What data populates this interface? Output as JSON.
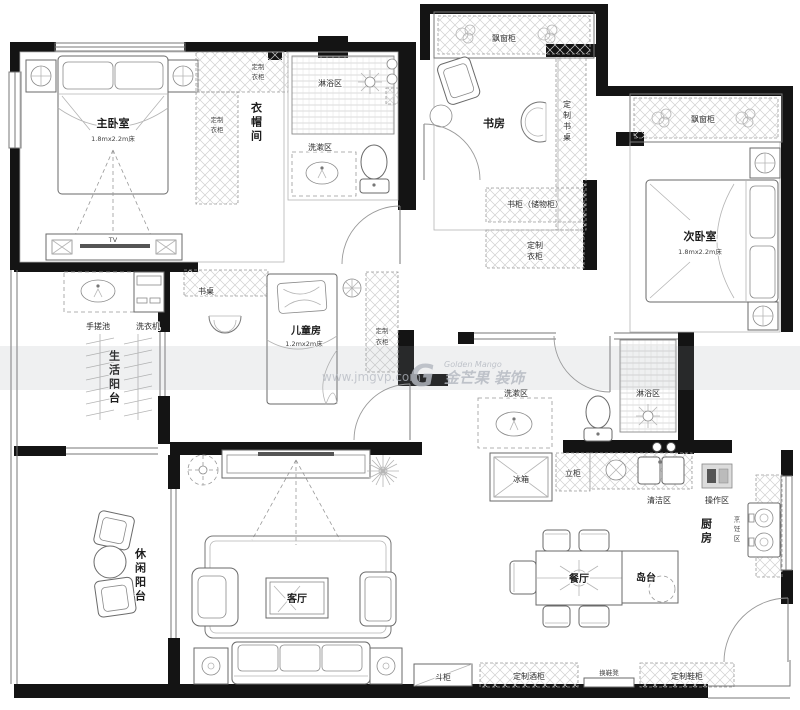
{
  "watermark": {
    "url": "www.jmgvp.com",
    "logo_letter": "G",
    "brand_en": "Golden Mango",
    "brand_cn": "金芒果 装饰"
  },
  "labels": {
    "master_bedroom": "主卧室",
    "master_bed_size": "1.8mx2.2m床",
    "cloakroom": "衣帽间",
    "wardrobe_top": {
      "l1": "定制",
      "l2": "衣柜"
    },
    "wardrobe_side": {
      "l1": "定制",
      "l2": "衣柜"
    },
    "master_shower": "淋浴区",
    "master_wash": "洗漱区",
    "tv": "TV",
    "study": "书房",
    "study_bay": "飘窗柜",
    "study_desk": "定制书桌",
    "bookcase": "书柜（储物柜）",
    "hall_wardrobe": {
      "l1": "定制",
      "l2": "衣柜"
    },
    "bedroom2": "次卧室",
    "bedroom2_bed_size": "1.8mx2.2m床",
    "bedroom2_bay": "飘窗柜",
    "kids_room": "儿童房",
    "kids_bed_size": "1.2mx2m床",
    "kids_desk": "书桌",
    "kids_wardrobe": {
      "l1": "定制",
      "l2": "衣柜"
    },
    "life_balcony": "生活阳台",
    "hand_sink": "手搓池",
    "washer": "洗衣机",
    "bath2_wash": "洗漱区",
    "bath2_shower": "淋浴区",
    "fridge": "冰箱",
    "tall_cabinet": "立柜",
    "clean_zone": "清洁区",
    "prep_zone": "操作区",
    "kitchen": "厨房",
    "cook_zone": "烹饪区",
    "dining": "餐厅",
    "island": "岛台",
    "living": "客厅",
    "leisure_balcony": "休闲阳台",
    "chest": "斗柜",
    "wine_cabinet": "定制酒柜",
    "shoe_bench": "换鞋凳",
    "shoe_cabinet": "定制鞋柜"
  }
}
